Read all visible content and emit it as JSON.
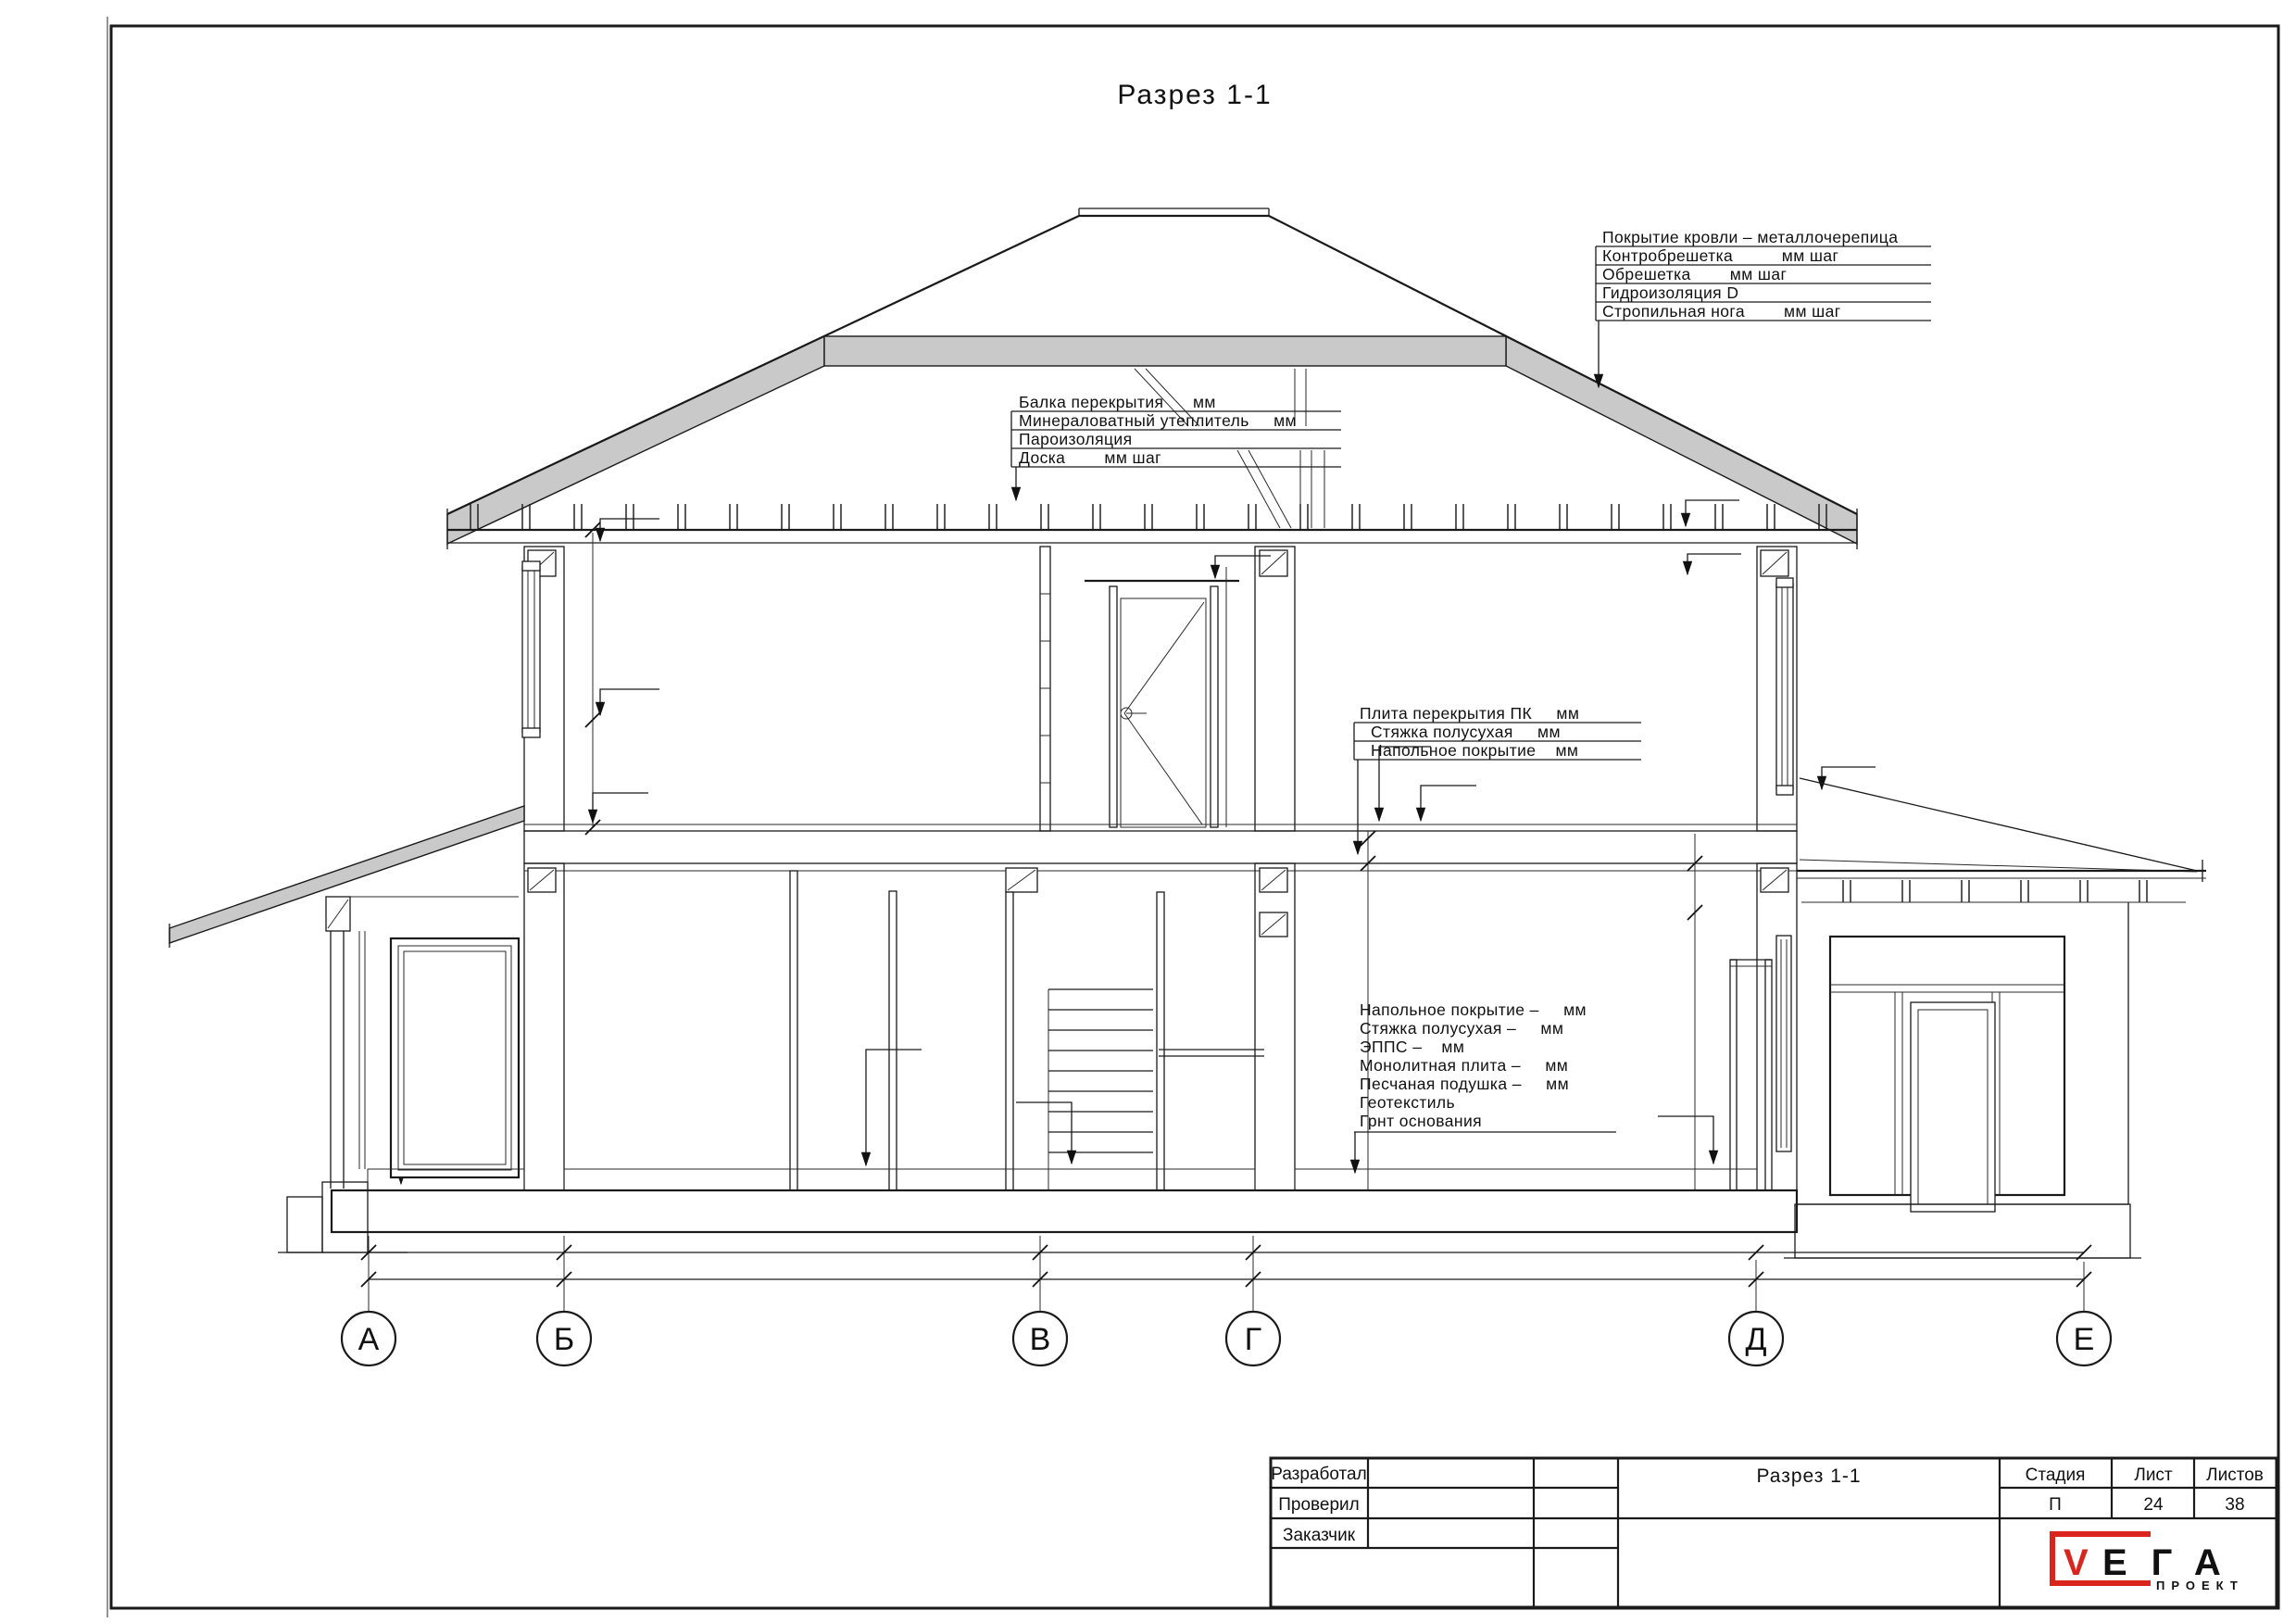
{
  "sheet": {
    "title": "Разрез 1-1"
  },
  "annotations": {
    "roof": {
      "lines": [
        "Покрытие кровли – металлочерепица",
        "Контробрешетка          мм шаг",
        "Обрешетка        мм шаг",
        "Гидроизоляция D",
        "Стропильная нога        мм шаг"
      ]
    },
    "ceiling": {
      "lines": [
        "Балка перекрытия      мм",
        "Минераловатный утеплитель     мм",
        "Пароизоляция",
        "Доска        мм шаг"
      ]
    },
    "slab": {
      "lines": [
        "Плита перекрытия ПК     мм",
        "Стяжка полусухая     мм",
        "Напольное покрытие    мм"
      ]
    },
    "floor": {
      "lines": [
        "Напольное покрытие –     мм",
        "Стяжка полусухая –     мм",
        "ЭППС –    мм",
        "Монолитная плита –     мм",
        "Песчаная подушка –     мм",
        "Геотекстиль",
        "Грнт основания"
      ]
    }
  },
  "axes": {
    "labels": [
      "А",
      "Б",
      "В",
      "Г",
      "Д",
      "Е"
    ]
  },
  "title_block": {
    "developed_label": "Разработал",
    "checked_label": "Проверил",
    "customer_label": "Заказчик",
    "doc_title": "Разрез 1-1",
    "stage_label": "Стадия",
    "sheet_label": "Лист",
    "sheets_label": "Листов",
    "stage_value": "П",
    "sheet_value": "24",
    "sheets_value": "38",
    "logo": {
      "v": "V",
      "ega": "ЕГА",
      "project": "ПРОЕКТ"
    }
  },
  "colors": {
    "line": "#1a1a1a",
    "roof_band": "#c9c9c9",
    "logo_red": "#d9251d"
  }
}
